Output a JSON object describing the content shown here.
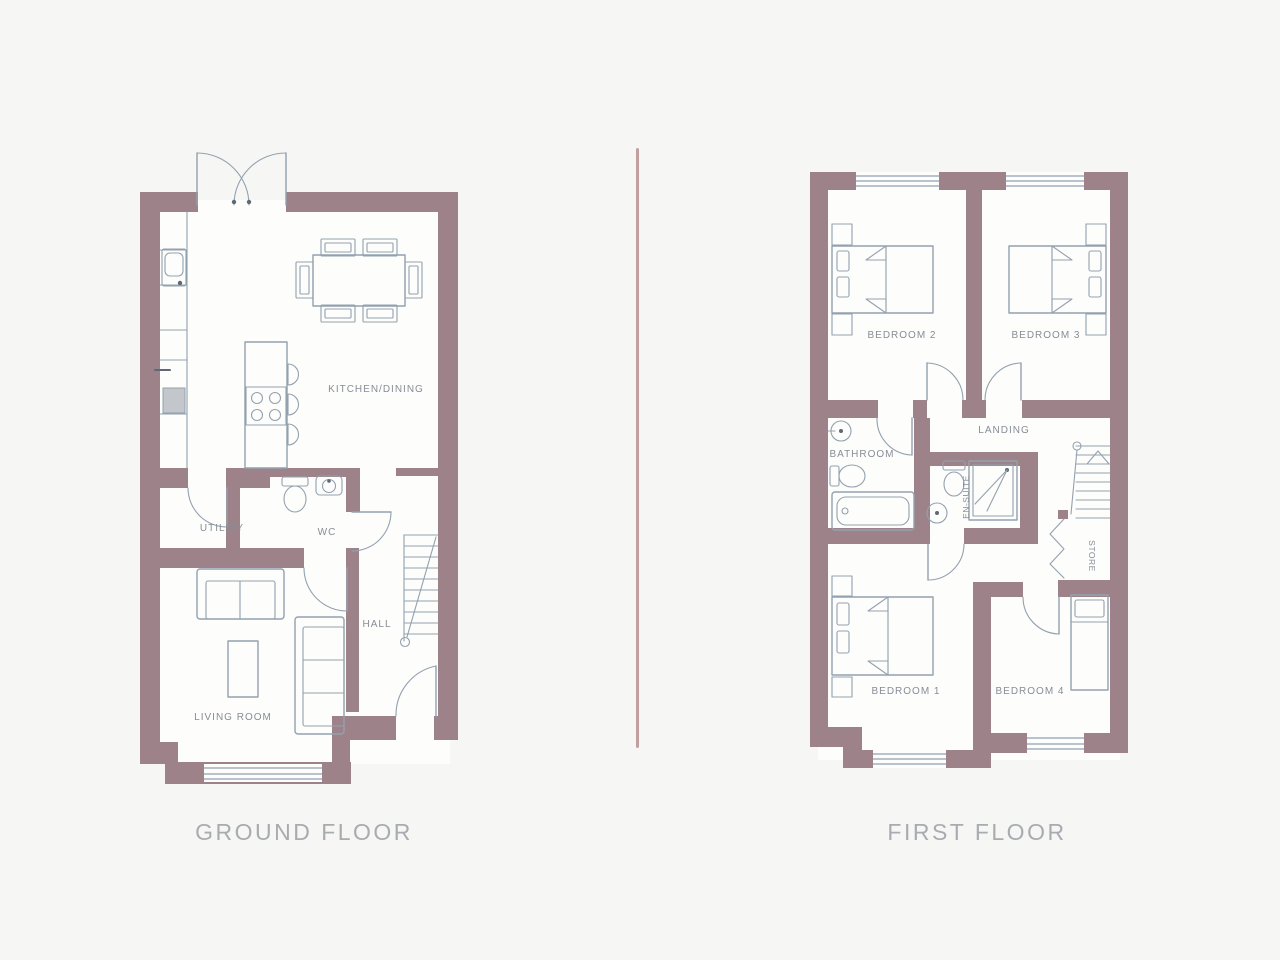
{
  "colors": {
    "bg": "#f6f7f5",
    "wall": "#9d8389",
    "line": "#93a1ae",
    "label": "#878d96",
    "title": "#a8abb0",
    "divider": "#b9908f",
    "appliance": "#c3c7cc"
  },
  "ground_floor": {
    "title": "GROUND FLOOR",
    "rooms": {
      "kitchen_dining": "KITCHEN/DINING",
      "utility": "UTILITY",
      "wc": "WC",
      "hall": "HALL",
      "living_room": "LIVING ROOM"
    }
  },
  "first_floor": {
    "title": "FIRST FLOOR",
    "rooms": {
      "bedroom_2": "BEDROOM 2",
      "bedroom_3": "BEDROOM 3",
      "landing": "LANDING",
      "bathroom": "BATHROOM",
      "en_suite": "EN-SUITE",
      "store": "STORE",
      "bedroom_1": "BEDROOM 1",
      "bedroom_4": "BEDROOM 4"
    }
  }
}
